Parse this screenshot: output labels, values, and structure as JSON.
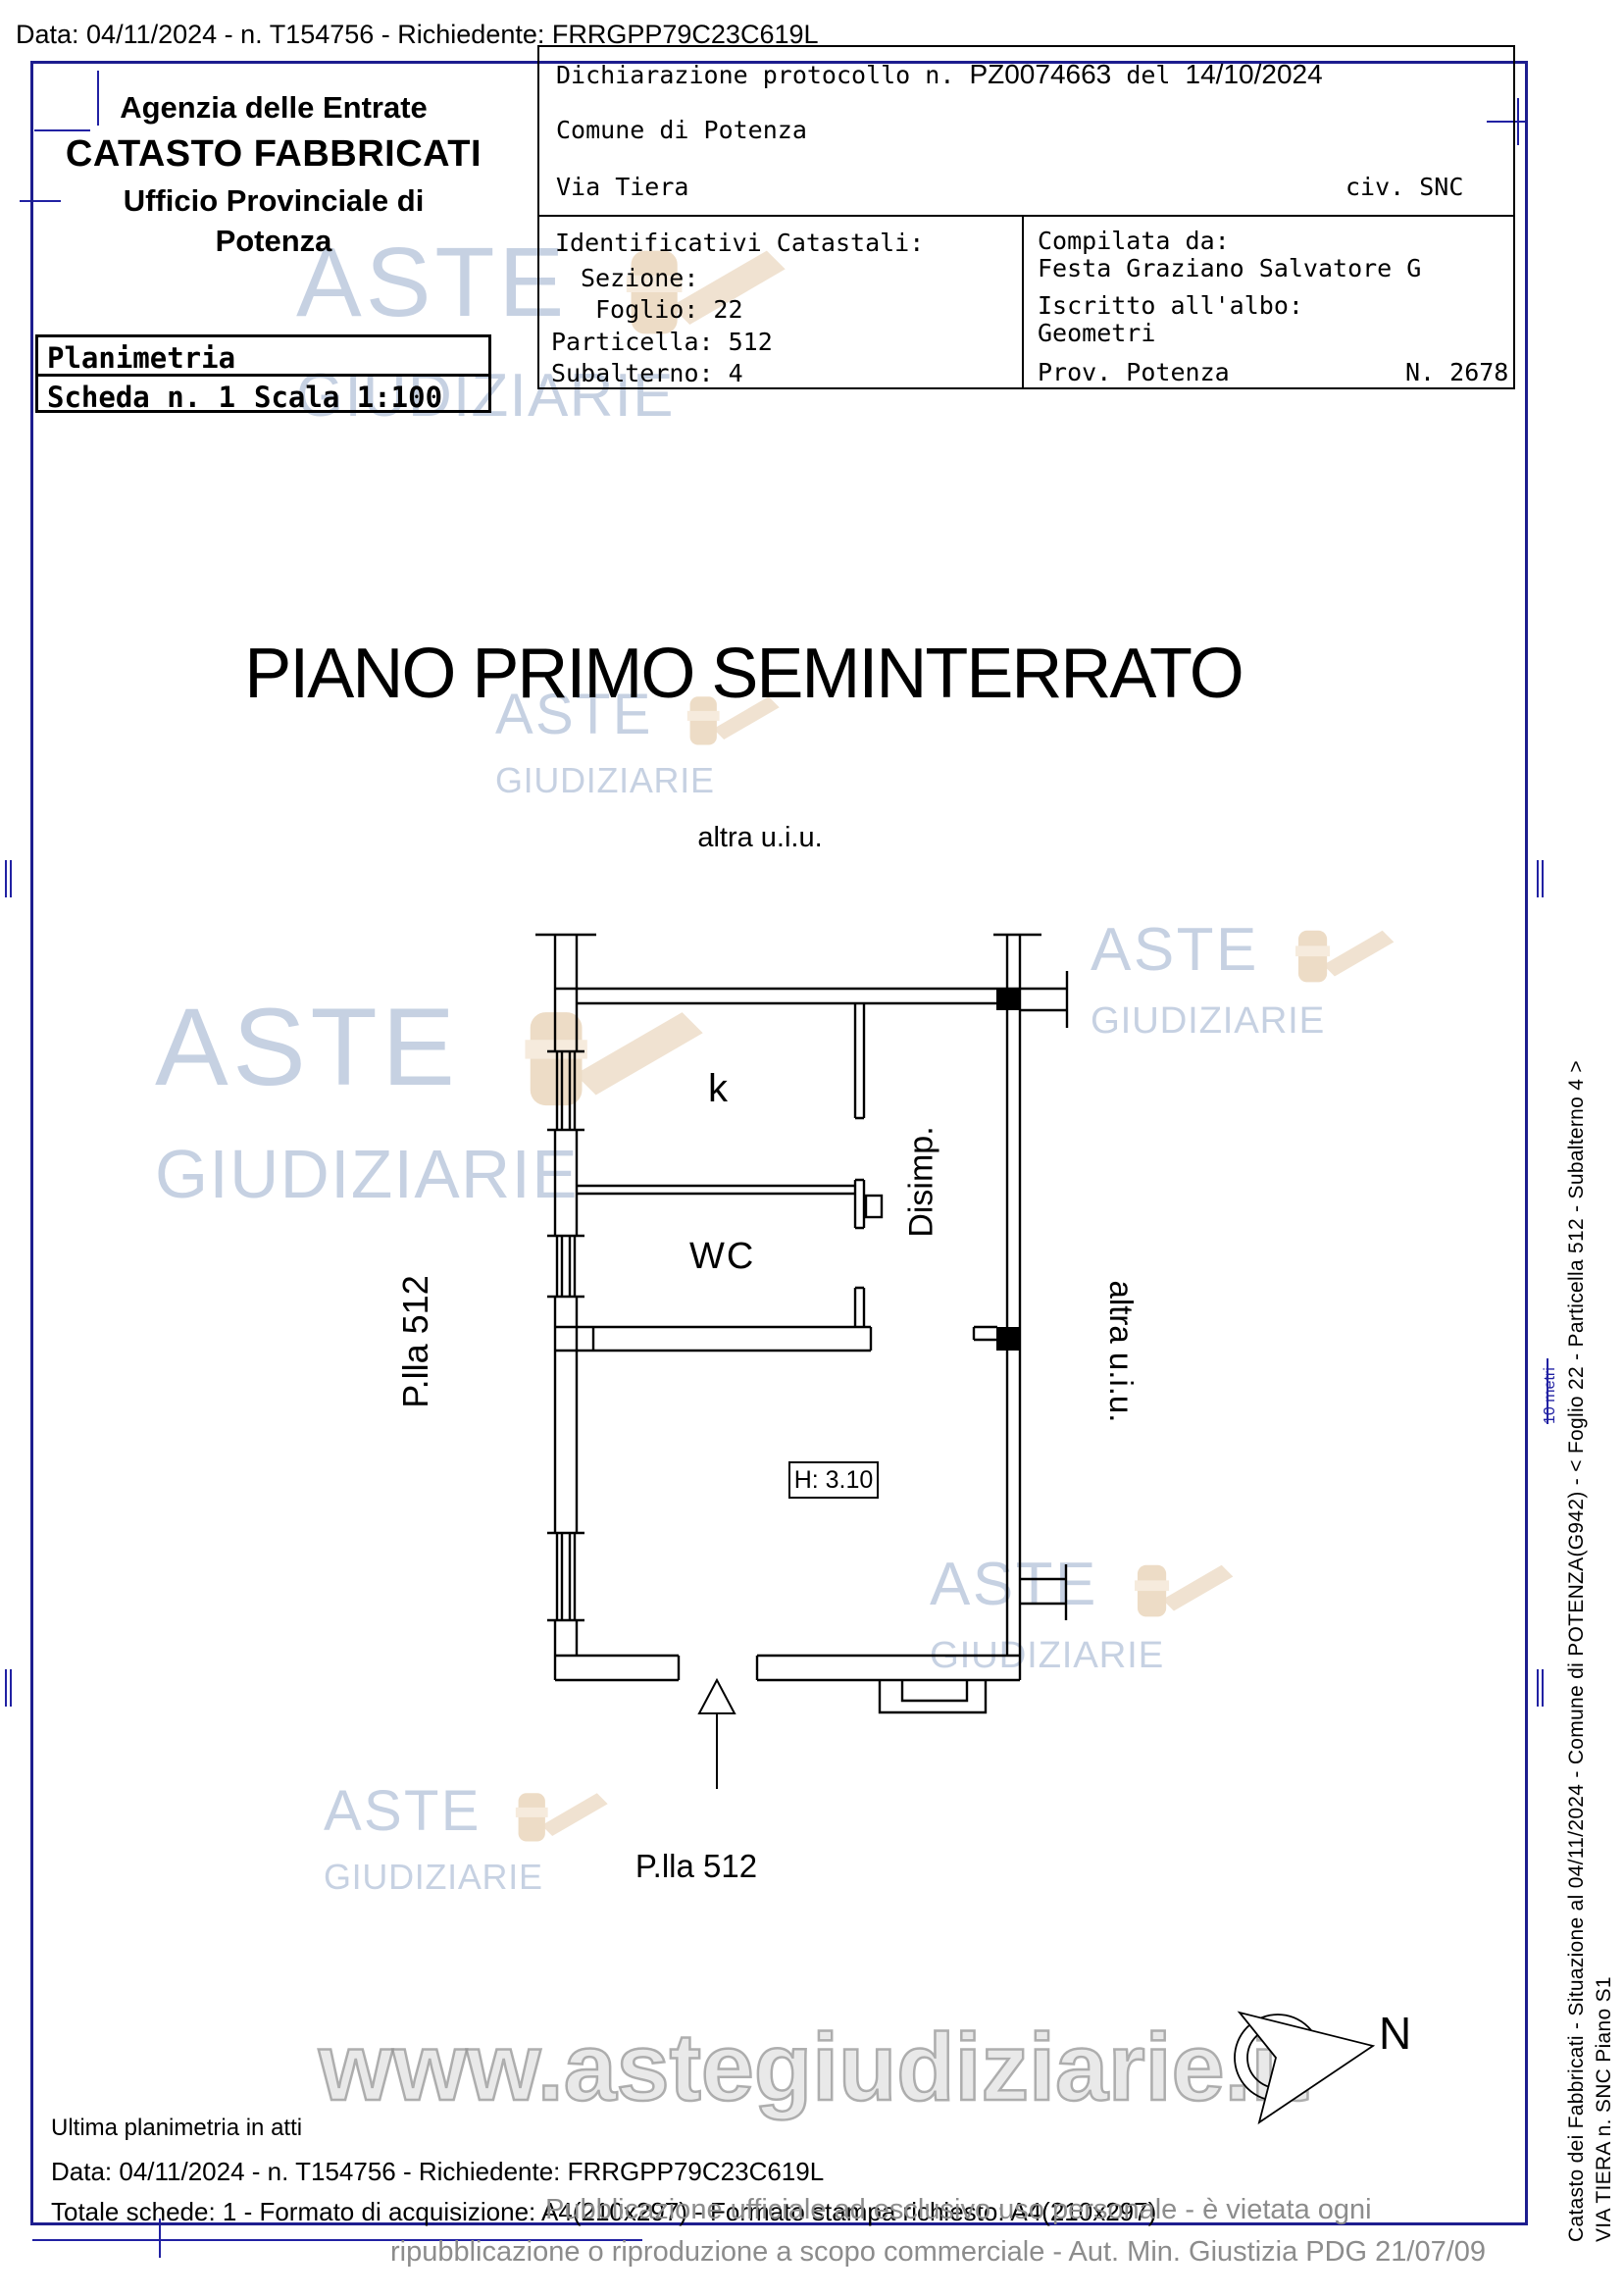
{
  "page": {
    "top_request_line": "Data: 04/11/2024 - n. T154756 - Richiedente: FRRGPP79C23C619L"
  },
  "header": {
    "agency_line1": "Agenzia delle Entrate",
    "agency_line2": "CATASTO FABBRICATI",
    "agency_line3": "Ufficio Provinciale di",
    "agency_line4": "Potenza",
    "table": {
      "row1": "Planimetria",
      "scheda": "Scheda n. 1",
      "scala": "Scala 1:100"
    }
  },
  "declaration": {
    "protocol_prefix": "Dichiarazione protocollo n.",
    "protocol_number": "PZ0074663",
    "protocol_mid": "del",
    "protocol_date": "14/10/2024",
    "comune": "Comune di Potenza",
    "street": "Via Tiera",
    "civic": "civ. SNC",
    "identifiers": {
      "title": "Identificativi Catastali:",
      "sezione": "Sezione:",
      "foglio": "Foglio: 22",
      "particella": "Particella: 512",
      "subalterno": "Subalterno: 4"
    },
    "compiler": {
      "label": "Compilata da:",
      "name": "Festa Graziano Salvatore G",
      "albo_label": "Iscritto all'albo:",
      "albo": "Geometri",
      "prov": "Prov. Potenza",
      "number": "N. 2678"
    }
  },
  "plan": {
    "title": "PIANO PRIMO SEMINTERRATO",
    "label_top": "altra u.i.u.",
    "label_left": "P.lla 512",
    "label_right": "altra u.i.u.",
    "label_bottom": "P.lla 512",
    "room_k": "k",
    "room_wc": "WC",
    "room_disimp": "Disimp.",
    "height_note": "H: 3.10",
    "compass_n": "N",
    "scale_note": "10 metri"
  },
  "sidebar": {
    "line1": "Catasto dei Fabbricati - Situazione al 04/11/2024 - Comune di POTENZA(G942) - < Foglio 22 - Particella 512 - Subalterno 4 >",
    "line2": "VIA TIERA n. SNC Piano S1"
  },
  "footer": {
    "note": "Ultima planimetria in atti",
    "request_line": "Data: 04/11/2024 - n. T154756 - Richiedente: FRRGPP79C23C619L",
    "sheets_line": "Totale schede: 1 - Formato di acquisizione: A4(210x297) - Formato stampa richiesto: A4(210x297)"
  },
  "watermark": {
    "line1": "ASTE",
    "line2": "GIUDIZIARIE",
    "url": "www.astegiudiziarie.it",
    "disclaimer_line1": "Pubblicazione ufficiale ad esclusivo uso personale - è vietata ogni",
    "disclaimer_line2": "ripubblicazione o riproduzione a scopo commerciale - Aut. Min. Giustizia PDG 21/07/09"
  },
  "colors": {
    "border_navy": "#1d1d8f",
    "watermark_blue": "#b9c6dc",
    "watermark_tan": "#ecd8bf",
    "disclaimer_gray": "#8c8c8c"
  }
}
